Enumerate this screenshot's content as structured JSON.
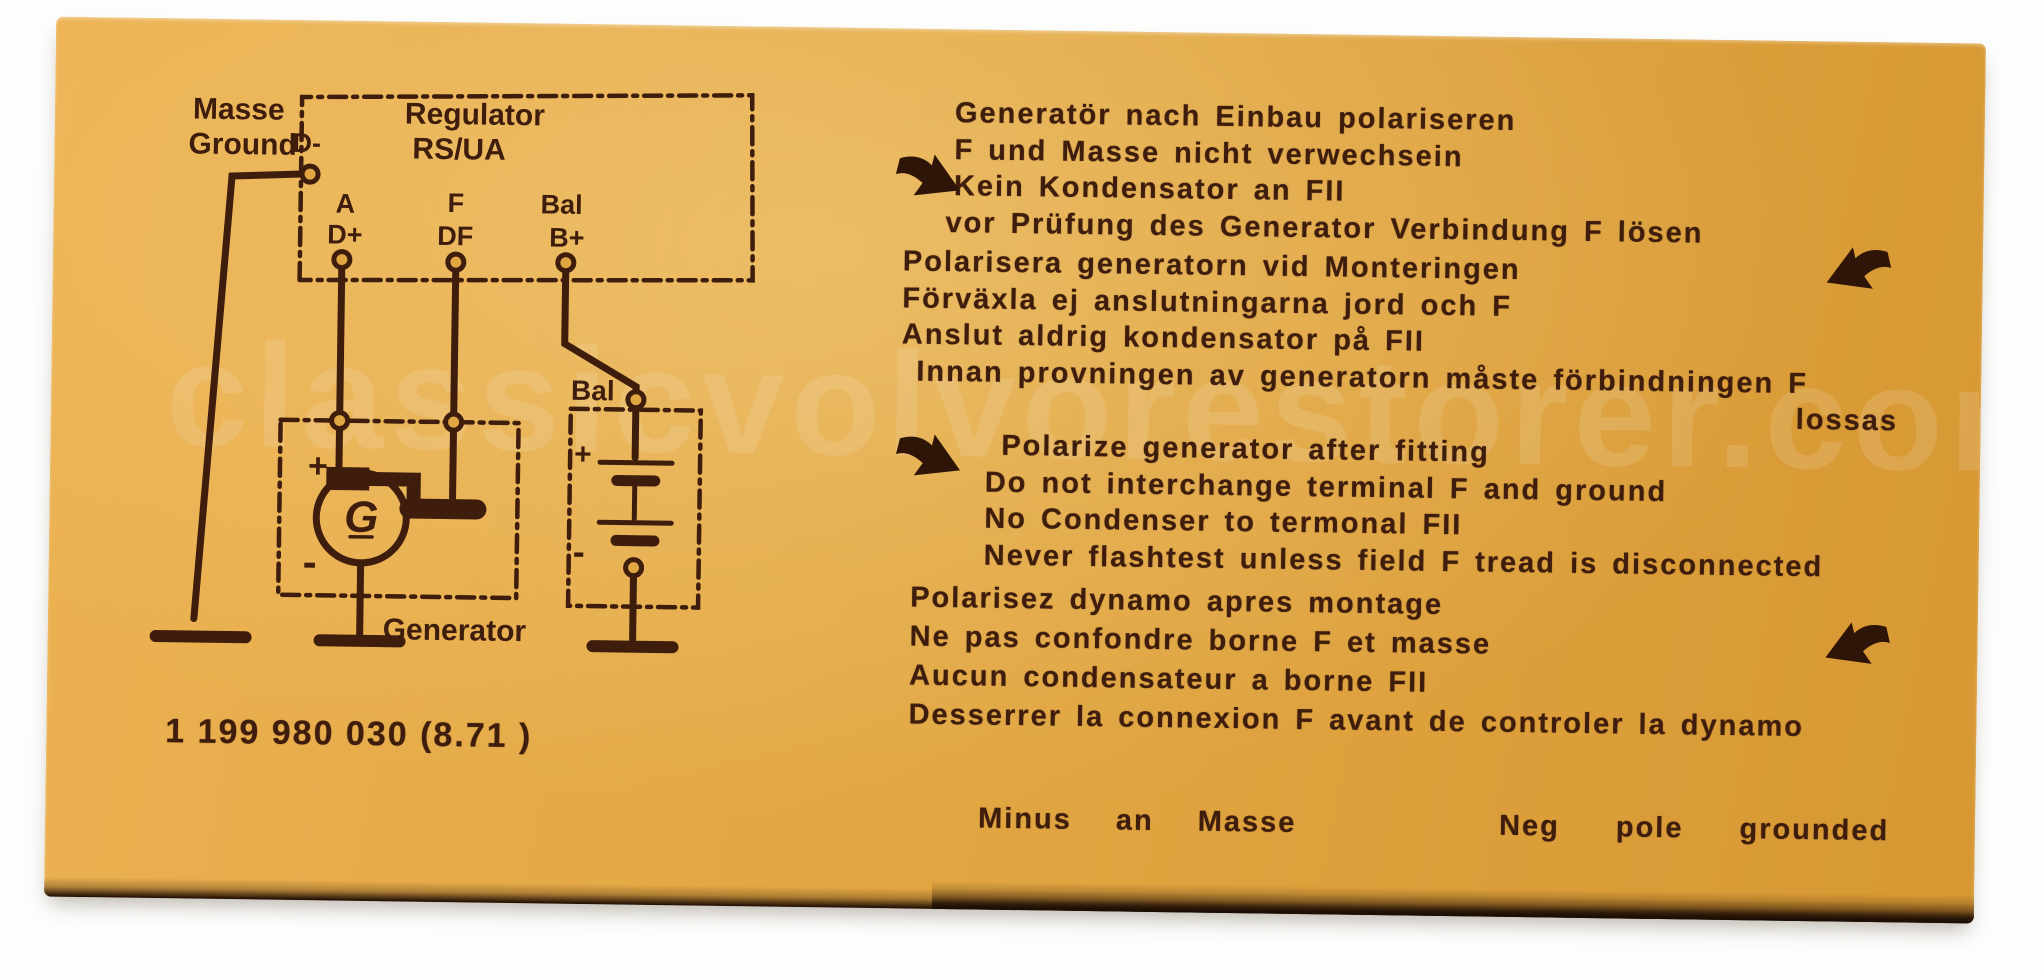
{
  "colors": {
    "label_orange": "#e2a743",
    "ink": "#3f1d0c",
    "background": "#ffffff"
  },
  "watermark": "classicvolvorestorer.com",
  "part_number": "1 199 980 030 (8.71 )",
  "diagram": {
    "ground_label": [
      "Masse",
      "Ground"
    ],
    "regulator": {
      "title": "Regulator",
      "model": "RS/UA",
      "terminal_top": "D-",
      "terminals": [
        {
          "row1": "A",
          "row2": "D+"
        },
        {
          "row1": "F",
          "row2": "DF"
        },
        {
          "row1": "Bal",
          "row2": "B+"
        }
      ]
    },
    "generator": {
      "symbol": "G",
      "label": "Generator",
      "plus": "+",
      "minus": "-"
    },
    "battery": {
      "label": "Bal",
      "plus": "+",
      "minus": "-"
    }
  },
  "instructions": {
    "german": [
      "Generatör nach Einbau polariseren",
      "F und Masse nicht verwechsein",
      "Kein Kondensator an FII",
      "vor Prüfung des Generator Verbindung F lösen"
    ],
    "swedish": [
      "Polarisera generatorn vid Monteringen",
      "Förväxla ej anslutningarna jord och F",
      "Anslut aldrig kondensator på FII",
      "Innan provningen av generatorn måste förbindningen F",
      "lossas"
    ],
    "english": [
      "Polarize generator after fitting",
      "Do not interchange terminal F and ground",
      "No Condenser to termonal FII",
      "Never flashtest unless field F tread is disconnected"
    ],
    "french": [
      "Polarisez dynamo apres montage",
      "Ne pas confondre borne F et masse",
      "Aucun condensateur a borne FII",
      "Desserrer la connexion F avant de controler la dynamo"
    ]
  },
  "footer": {
    "left_words": [
      "Minus",
      "an",
      "Masse"
    ],
    "right_words": [
      "Neg",
      "pole",
      "grounded"
    ]
  },
  "icons": {
    "arrow_down_right": "bold-arrow-down-right",
    "arrow_down_left": "bold-arrow-down-left"
  }
}
